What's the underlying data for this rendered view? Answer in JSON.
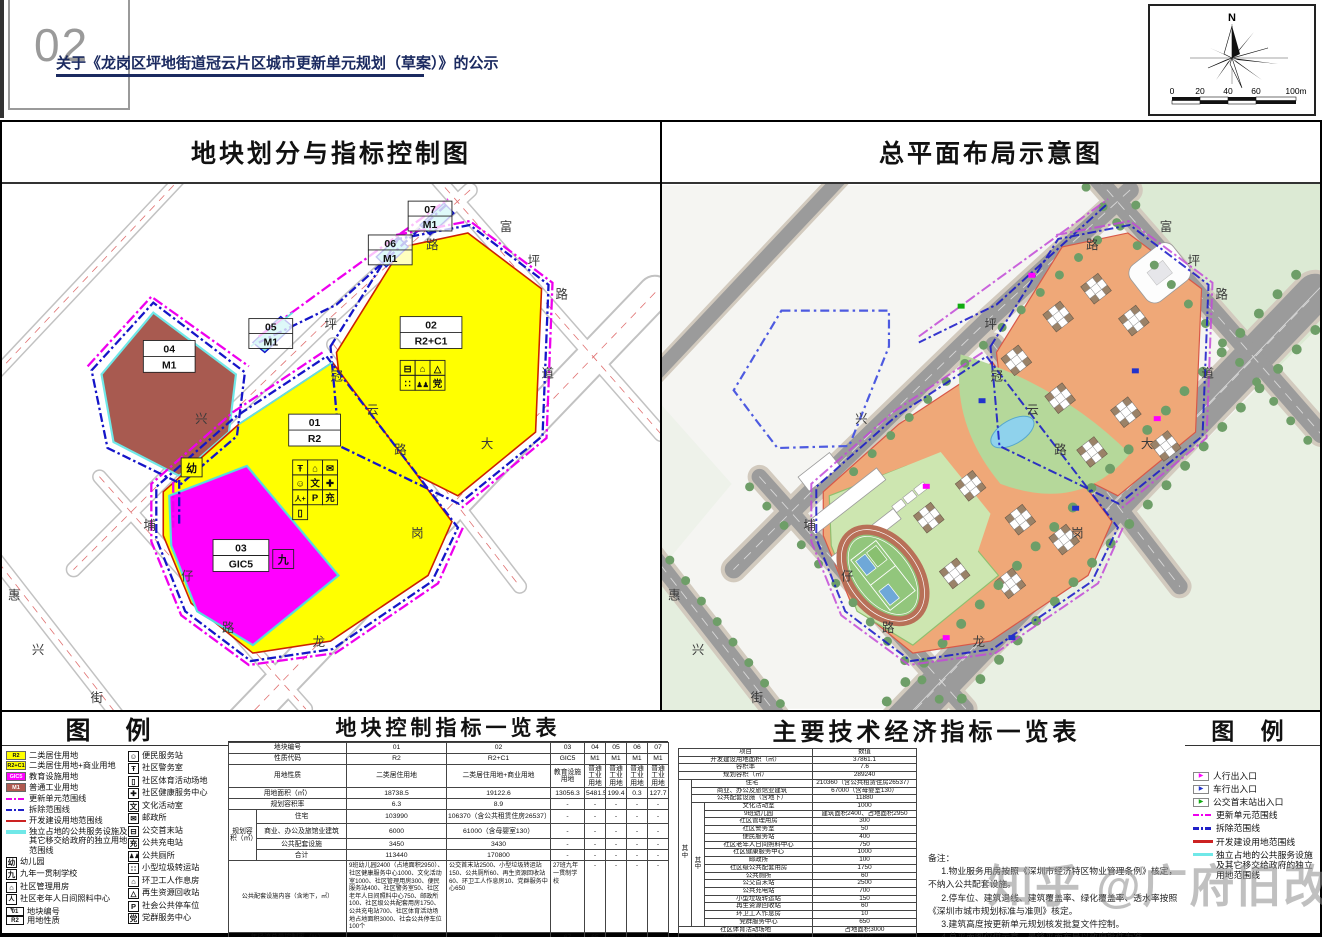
{
  "page": {
    "number": "02",
    "title": "关于《龙岗区坪地街道冠云片区城市更新单元规划（草案）》的公示",
    "watermark": "知乎 @广府旧改"
  },
  "compass": {
    "north_label": "N",
    "scale_ticks": [
      "0",
      "20",
      "40",
      "60",
      "100m"
    ]
  },
  "panels": {
    "left_title": "地块划分与指标控制图",
    "right_title": "总平面布局示意图"
  },
  "colors": {
    "residential": "#ffff00",
    "education": "#ff00ff",
    "industry": "#b05a50",
    "unit_line": "#ee00ee",
    "demolish_line": "#2020c8",
    "develop_line": "#cc2222",
    "independent_line": "#70e8e8"
  },
  "map_labels": {
    "plots": [
      {
        "code": "01",
        "type": "R2"
      },
      {
        "code": "02",
        "type": "R2+C1"
      },
      {
        "code": "03",
        "type": "GIC5"
      },
      {
        "code": "04",
        "type": "M1"
      },
      {
        "code": "05",
        "type": "M1"
      },
      {
        "code": "06",
        "type": "M1"
      },
      {
        "code": "07",
        "type": "M1"
      }
    ],
    "kindergarten": "幼",
    "school": "九",
    "roads": {
      "fuping": [
        "富",
        "坪",
        "路"
      ],
      "pinglu": [
        "坪",
        "路"
      ],
      "guanyun": [
        "冠",
        "云",
        "路"
      ],
      "xing": "兴",
      "puzai": [
        "埔",
        "仔",
        "路"
      ],
      "longgang": [
        "龙",
        "岗",
        "大",
        "道"
      ],
      "huixing": [
        "惠",
        "兴",
        "街"
      ]
    }
  },
  "icons": {
    "b01": [
      "Ŧ",
      "⌂",
      "✉",
      "☺",
      "文",
      "✚",
      "人+",
      "P",
      "充",
      "▯"
    ],
    "b02": [
      "⊟",
      "⌂",
      "△",
      "∷",
      "♟♟",
      "党"
    ]
  },
  "legend_left": {
    "title": "图  例",
    "items1": [
      {
        "t": "R2",
        "label": "二类居住用地"
      },
      {
        "t": "R2+C1",
        "label": "二类居住用地+商业用地"
      },
      {
        "t": "GIC5",
        "label": "教育设施用地"
      },
      {
        "t": "M1",
        "label": "普通工业用地"
      },
      {
        "label": "更新单元范围线"
      },
      {
        "label": "拆除范围线"
      },
      {
        "label": "开发建设用地范围线"
      },
      {
        "label": "独立占地的公共服务设施及其它移交给政府的独立用地范围线"
      },
      {
        "g": "幼",
        "label": "幼儿园"
      },
      {
        "g": "九",
        "label": "九年一贯制学校"
      },
      {
        "g": "⌂",
        "label": "社区管理用房"
      },
      {
        "g": "人+",
        "label": "社区老年人日间照料中心"
      },
      {
        "g1": "01",
        "g2": "R2",
        "label1": "地块编号",
        "label2": "用地性质"
      }
    ],
    "items2": [
      {
        "g": "☺",
        "label": "便民服务站"
      },
      {
        "g": "Ŧ",
        "label": "社区警务室"
      },
      {
        "g": "▯",
        "label": "社区体育活动场地"
      },
      {
        "g": "✚",
        "label": "社区健康服务中心"
      },
      {
        "g": "文",
        "label": "文化活动室"
      },
      {
        "g": "✉",
        "label": "邮政所"
      },
      {
        "g": "⊟",
        "label": "公交首末站"
      },
      {
        "g": "充",
        "label": "公共充电站"
      },
      {
        "g": "♟♟",
        "label": "公共厕所"
      },
      {
        "g": "∷",
        "label": "小型垃圾转运站"
      },
      {
        "g": "⌂",
        "label": "环卫工人作息房"
      },
      {
        "g": "△",
        "label": "再生资源回收站"
      },
      {
        "g": "P",
        "label": "社会公共停车位"
      },
      {
        "g": "党",
        "label": "党群服务中心"
      }
    ]
  },
  "legend_right": {
    "title": "图  例",
    "items": [
      {
        "label": "人行出入口"
      },
      {
        "label": "车行出入口"
      },
      {
        "label": "公交首末站出入口"
      },
      {
        "label": "更新单元范围线"
      },
      {
        "label": "拆除范围线"
      },
      {
        "label": "开发建设用地范围线"
      },
      {
        "label": "独立占地的公共服务设施及其它移交给政府的独立用地范围线"
      }
    ]
  },
  "table_plots": {
    "title": "地块控制指标一览表",
    "code_label": "地块编号",
    "codes": [
      "01",
      "02",
      "03",
      "04",
      "05",
      "06",
      "07"
    ],
    "nature_label": "性质代码",
    "natures": [
      "R2",
      "R2+C1",
      "GIC5",
      "M1",
      "M1",
      "M1",
      "M1"
    ],
    "use_label": "用地性质",
    "uses": [
      "二类居住用地",
      "二类居住用地+商业用地",
      "教育设施用地",
      "普通工业用地",
      "普通工业用地",
      "普通工业用地",
      "普通工业用地"
    ],
    "area_label": "用地面积（㎡）",
    "areas": [
      "18738.5",
      "19122.6",
      "13056.3",
      "5481.5",
      "199.4",
      "0.3",
      "127.7"
    ],
    "far_label": "规划容积率",
    "fars": [
      "6.3",
      "8.9",
      "-",
      "-",
      "-",
      "-",
      "-"
    ],
    "capacity_label": "规划容积（㎡）",
    "residential_label": "住宅",
    "residential": [
      "103990",
      "106370（含公共租赁住房26537）",
      "-",
      "-",
      "-",
      "-",
      "-"
    ],
    "commercial_label": "商业、办公及旅馆业建筑",
    "commercial": [
      "6000",
      "61000（含母婴室130）",
      "-",
      "-",
      "-",
      "-",
      "-"
    ],
    "facility_label": "公共配套设施",
    "facility": [
      "3450",
      "3430",
      "-",
      "-",
      "-",
      "-",
      "-"
    ],
    "total_label": "合计",
    "totals": [
      "113440",
      "170800",
      "-",
      "-",
      "-",
      "-",
      "-"
    ],
    "content_label": "公共配套设施内容（含地下，㎡）",
    "contents": [
      "9班幼儿园2400（占地面积2950）、社区健康服务中心1000、文化活动室1000、社区管理用房300、便民服务站400、社区警务室50、社区老年人日间照料中心750、邮政所100、社区级公共配套用房1750、公共充电站700、社区体育活动场地占地面积3000、社会公共停车位100个",
      "公交首末站2500、小型垃圾转运站150、公共厕所60、再生资源回收站60、环卫工人作息房10、党群服务中心650",
      "27班九年一贯制学校",
      "-",
      "-",
      "-",
      "-"
    ],
    "runoff_label": "年径流总量控制率（%）",
    "runoffs": [
      "66",
      "66",
      "67",
      "65",
      "-",
      "-",
      "-"
    ],
    "remark_label": "备注",
    "remarks": [
      "拆除重建",
      "拆除重建",
      "拆除重建",
      "拆除重建",
      "拆除重建",
      "拆除重建",
      "拆除重建"
    ]
  },
  "table_tech": {
    "title": "主要技术经济指标一览表",
    "header": [
      "项目",
      "数值"
    ],
    "zhong": "其中",
    "rows": [
      {
        "label": "开发建设用地面积（㎡）",
        "value": "37861.1"
      },
      {
        "label": "容积率",
        "value": "7.6"
      },
      {
        "label": "规划容积（㎡）",
        "value": "289240"
      },
      {
        "label": "住宅",
        "value": "210360（含公共租赁住房26537）"
      },
      {
        "label": "商业、办公及旅馆业建筑",
        "value": "67000（含母婴室130）"
      },
      {
        "label": "公共配套设施（含地下）",
        "value": "11880"
      },
      {
        "label": "文化活动室",
        "value": "1000"
      },
      {
        "label": "9班幼儿园",
        "value": "建筑面积2400、占地面积2950"
      },
      {
        "label": "社区管理用房",
        "value": "300"
      },
      {
        "label": "社区警务室",
        "value": "50"
      },
      {
        "label": "便民服务站",
        "value": "400"
      },
      {
        "label": "社区老年人日间照料中心",
        "value": "750"
      },
      {
        "label": "社区健康服务中心",
        "value": "1000"
      },
      {
        "label": "邮政所",
        "value": "100"
      },
      {
        "label": "社区级公共配套用房",
        "value": "1750"
      },
      {
        "label": "公共厕所",
        "value": "60"
      },
      {
        "label": "公交首末站",
        "value": "2500"
      },
      {
        "label": "公共充电站",
        "value": "700"
      },
      {
        "label": "小型垃圾转运站",
        "value": "150"
      },
      {
        "label": "再生资源回收站",
        "value": "60"
      },
      {
        "label": "环卫工人作息房",
        "value": "10"
      },
      {
        "label": "党群服务中心",
        "value": "650"
      },
      {
        "label": "社区体育活动场地",
        "value": "占地面积3000"
      },
      {
        "label": "社会公共停车位",
        "value": "100个"
      }
    ],
    "notes_title": "备注：",
    "notes": [
      "1.物业服务用房按照《深圳市经济特区物业管理条例》核定，不纳入公共配套设施。",
      "2.停车位、建筑退线、建筑覆盖率、绿化覆盖率、透水率按照《深圳市城市规划标准与准则》核定。",
      "3.建筑高度按更新单元规划核发批复文件控制。",
      "4.总平面图仅供示意，最终平面布局以政府批件为准。"
    ]
  }
}
